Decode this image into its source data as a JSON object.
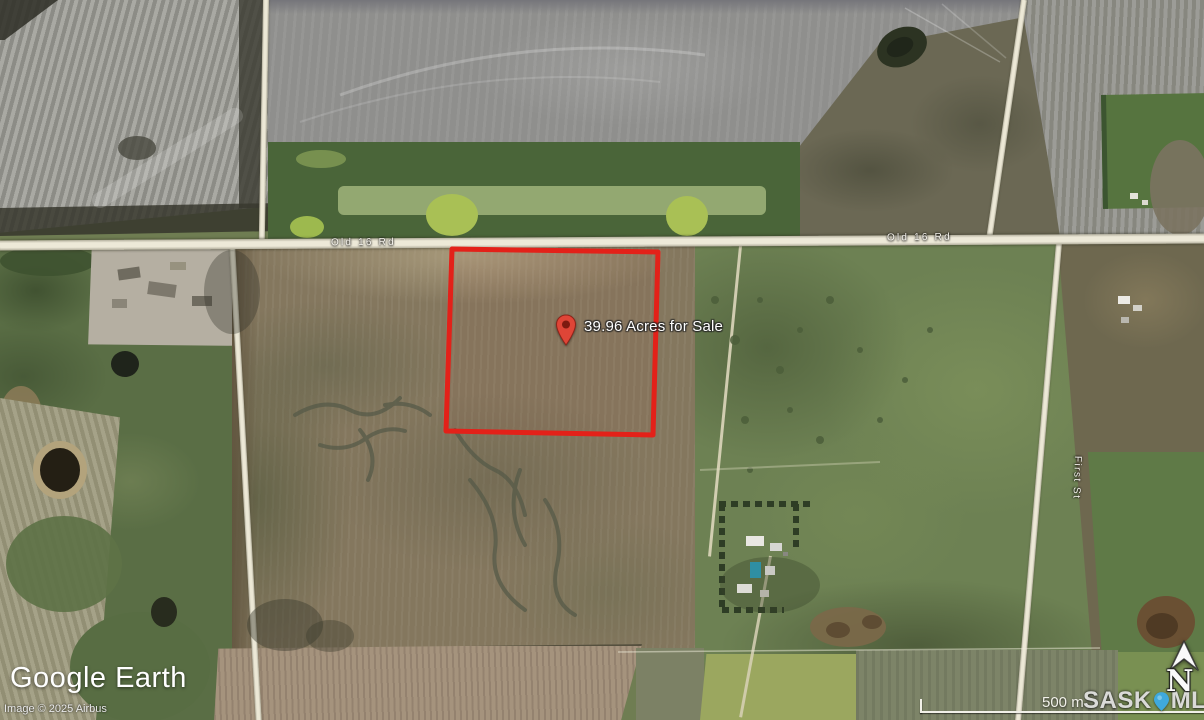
{
  "map": {
    "parcel_label": "39.96 Acres for Sale",
    "road_labels": {
      "left": "Old 16 Rd",
      "right": "Old 16 Rd"
    },
    "street_label": "First St",
    "branding": {
      "logo": "Google Earth",
      "copyright": "Image © 2025 Airbus"
    },
    "scale": {
      "label": "500 m"
    },
    "watermark": {
      "sask": "SASK",
      "mls": "MLS",
      "reg": "®"
    },
    "north": {
      "label": "N"
    },
    "colors": {
      "parcel_outline": "#e32119",
      "pin": "#df4537",
      "mls_pin": "#3fa9dc"
    }
  }
}
